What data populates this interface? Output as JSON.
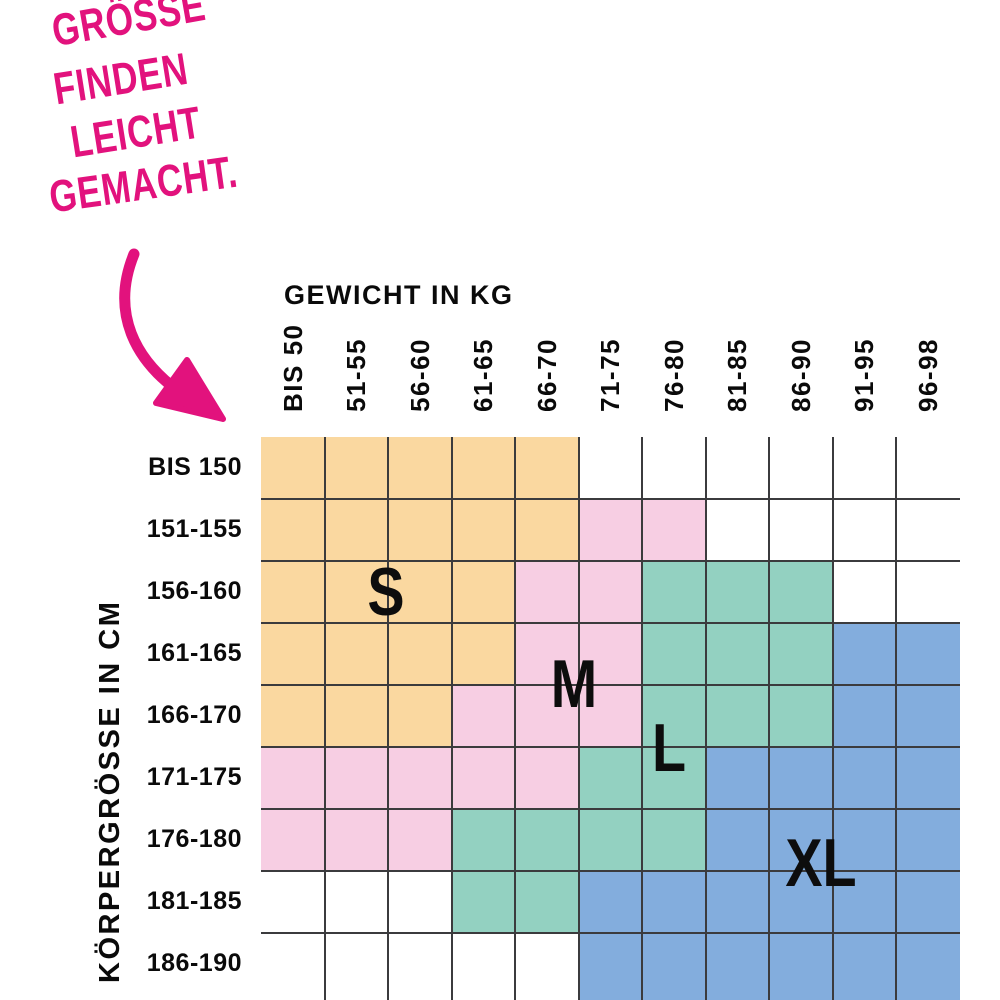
{
  "annotation": {
    "lines": [
      "GRÖSSE",
      "FINDEN",
      "LEICHT",
      "GEMACHT."
    ],
    "color": "#E2127D",
    "arrow_icon": "curved-arrow-pointing-down-right-to-grid"
  },
  "axes": {
    "x_title": "GEWICHT IN KG",
    "y_title": "KÖRPERGRÖSSE IN CM"
  },
  "chart_data": {
    "type": "heatmap",
    "title": "GRÖSSE FINDEN LEICHT GEMACHT.",
    "xlabel": "GEWICHT IN KG",
    "ylabel": "KÖRPERGRÖSSE IN CM",
    "x_categories": [
      "BIS 50",
      "51-55",
      "56-60",
      "61-65",
      "66-70",
      "71-75",
      "76-80",
      "81-85",
      "86-90",
      "91-95",
      "96-98"
    ],
    "y_categories": [
      "BIS 150",
      "151-155",
      "156-160",
      "161-165",
      "166-170",
      "171-175",
      "176-180",
      "181-185",
      "186-190"
    ],
    "matrix": [
      [
        "S",
        "S",
        "S",
        "S",
        "S",
        "",
        "",
        "",
        "",
        "",
        ""
      ],
      [
        "S",
        "S",
        "S",
        "S",
        "S",
        "M",
        "M",
        "",
        "",
        "",
        ""
      ],
      [
        "S",
        "S",
        "S",
        "S",
        "M",
        "M",
        "L",
        "L",
        "L",
        "",
        ""
      ],
      [
        "S",
        "S",
        "S",
        "S",
        "M",
        "M",
        "L",
        "L",
        "L",
        "XL",
        "XL"
      ],
      [
        "S",
        "S",
        "S",
        "M",
        "M",
        "M",
        "L",
        "L",
        "L",
        "XL",
        "XL"
      ],
      [
        "M",
        "M",
        "M",
        "M",
        "M",
        "L",
        "L",
        "XL",
        "XL",
        "XL",
        "XL"
      ],
      [
        "M",
        "M",
        "M",
        "L",
        "L",
        "L",
        "L",
        "XL",
        "XL",
        "XL",
        "XL"
      ],
      [
        "",
        "",
        "",
        "L",
        "L",
        "XL",
        "XL",
        "XL",
        "XL",
        "XL",
        "XL"
      ],
      [
        "",
        "",
        "",
        "",
        "",
        "XL",
        "XL",
        "XL",
        "XL",
        "XL",
        "XL"
      ]
    ],
    "colors": {
      "S": "#FAD8A0",
      "M": "#F7CEE3",
      "L": "#93D1C1",
      "XL": "#83ADDD",
      "empty": "#FFFFFF"
    },
    "grid_line_color": "#3B3B3D",
    "legend_position": "letters drawn inside their colored zones",
    "size_labels": [
      {
        "text": "S",
        "x": 386,
        "y": 592
      },
      {
        "text": "M",
        "x": 574,
        "y": 684
      },
      {
        "text": "L",
        "x": 669,
        "y": 748
      },
      {
        "text": "XL",
        "x": 821,
        "y": 863
      }
    ]
  }
}
